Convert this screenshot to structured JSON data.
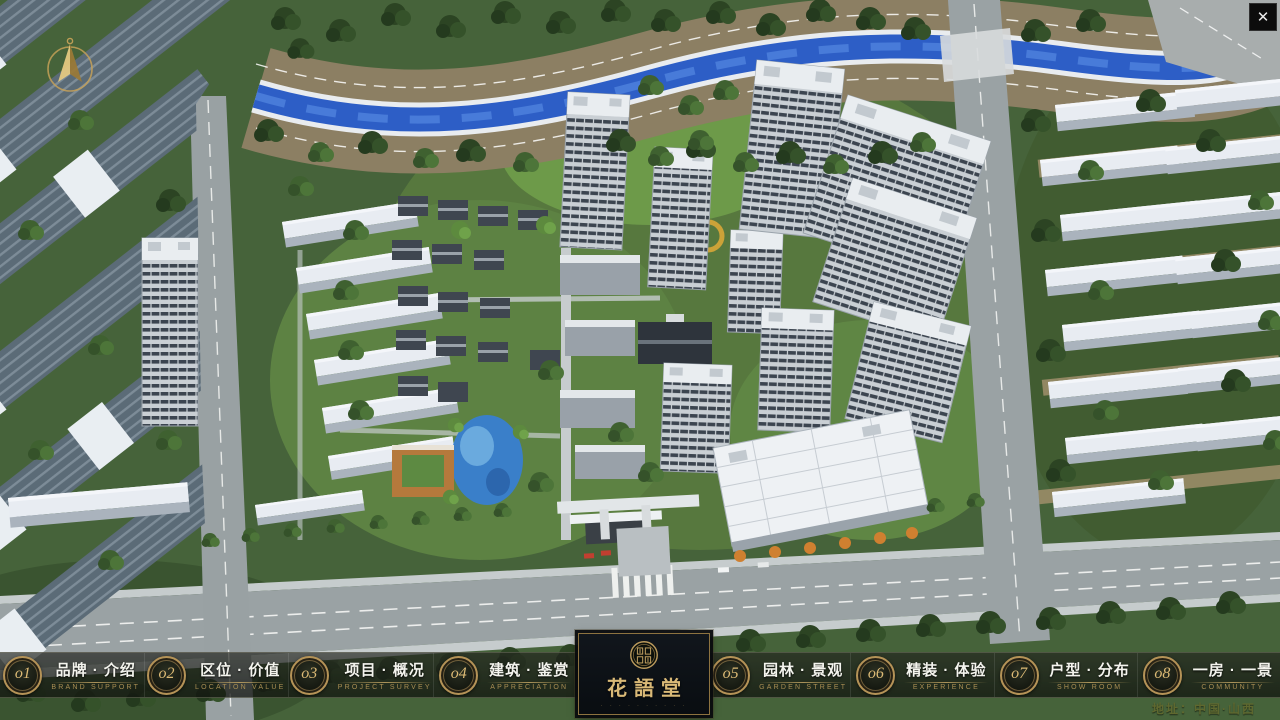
{
  "window": {
    "close_glyph": "✕"
  },
  "menu": {
    "items_left": [
      {
        "num": "o1",
        "zh": "品牌 · 介绍",
        "en": "BRAND SUPPORT"
      },
      {
        "num": "o2",
        "zh": "区位 · 价值",
        "en": "LOCATION VALUE"
      },
      {
        "num": "o3",
        "zh": "项目 · 概况",
        "en": "PROJECT SURVEY"
      },
      {
        "num": "o4",
        "zh": "建筑 · 鉴赏",
        "en": "APPRECIATION"
      }
    ],
    "items_right": [
      {
        "num": "o5",
        "zh": "园林 · 景观",
        "en": "GARDEN STREET"
      },
      {
        "num": "o6",
        "zh": "精装 · 体验",
        "en": "EXPERIENCE"
      },
      {
        "num": "o7",
        "zh": "户型 · 分布",
        "en": "SHOW ROOM"
      },
      {
        "num": "o8",
        "zh": "一房 · 一景",
        "en": "COMMUNITY"
      }
    ]
  },
  "logo": {
    "title": "花語堂",
    "caption": "· · · · · · · · · ·"
  },
  "footer": {
    "address": "地址：中国·山西"
  },
  "colors": {
    "gold_accent": "#b59357",
    "gold_text": "#d9b977",
    "bar_bg": "rgba(20,22,18,0.70)",
    "river_blue": "#2d5ec6",
    "grass_green": "#46633a"
  }
}
